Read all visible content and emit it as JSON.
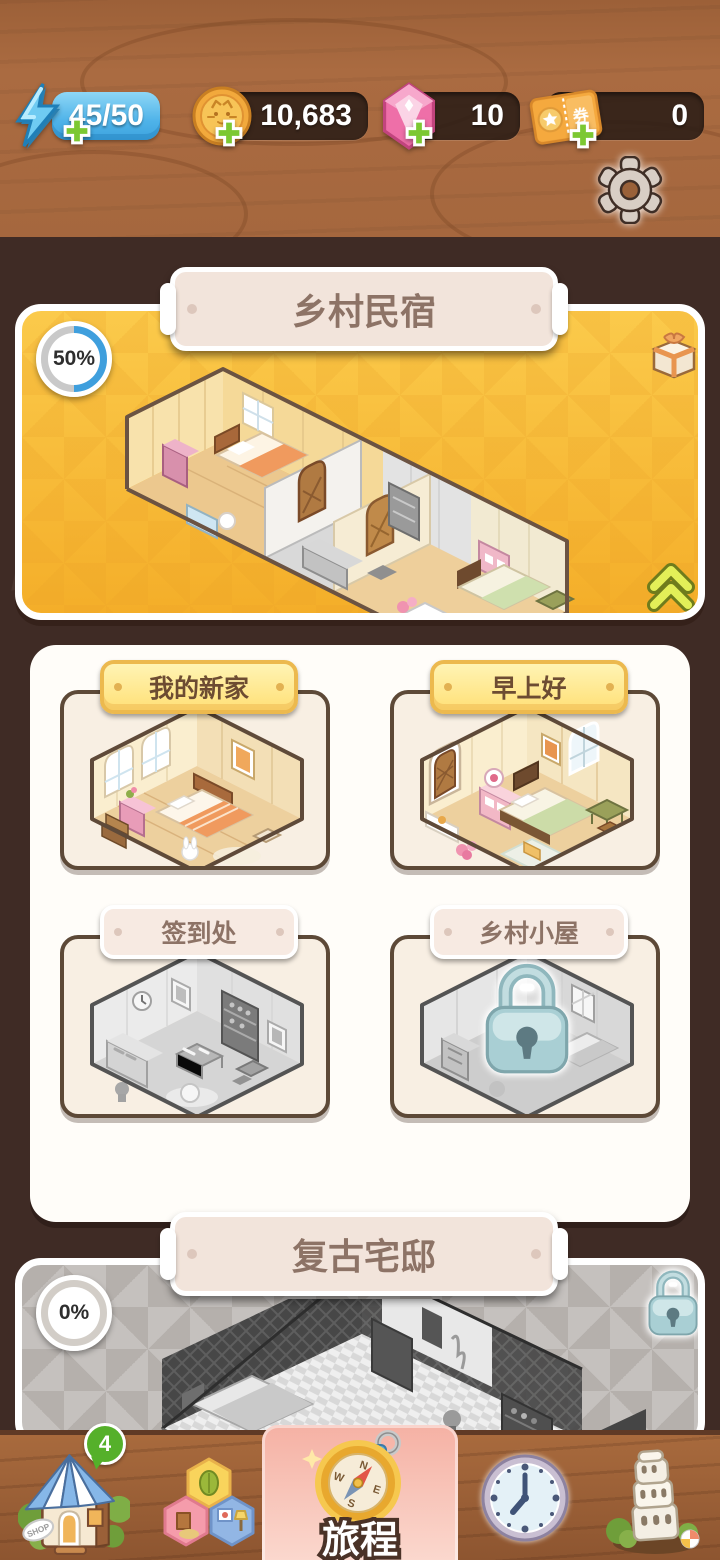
{
  "topbar": {
    "energy": {
      "value": "45/50"
    },
    "coins": {
      "value": "10,683"
    },
    "gems": {
      "value": "10"
    },
    "tickets": {
      "value": "0",
      "glyph": "券"
    }
  },
  "featured": {
    "title": "乡村民宿",
    "progress": "50%"
  },
  "rooms": [
    {
      "name": "我的新家",
      "state": "unlocked"
    },
    {
      "name": "早上好",
      "state": "unlocked"
    },
    {
      "name": "签到处",
      "state": "incomplete"
    },
    {
      "name": "乡村小屋",
      "state": "locked"
    }
  ],
  "next_section": {
    "title": "复古宅邸",
    "progress": "0%",
    "locked": true
  },
  "nav": {
    "shop_badge": "4",
    "shop_sign": "SHOP",
    "journey_label": "旅程",
    "compass": {
      "n": "N",
      "e": "E",
      "s": "S",
      "w": "W"
    }
  },
  "colors": {
    "progress_blue": "#3f9fdd",
    "card_yellow": "#f7bb33",
    "journey_pink": "#f7bdb0",
    "badge_green": "#55b02a",
    "lock_teal": "#a9cfd4"
  }
}
